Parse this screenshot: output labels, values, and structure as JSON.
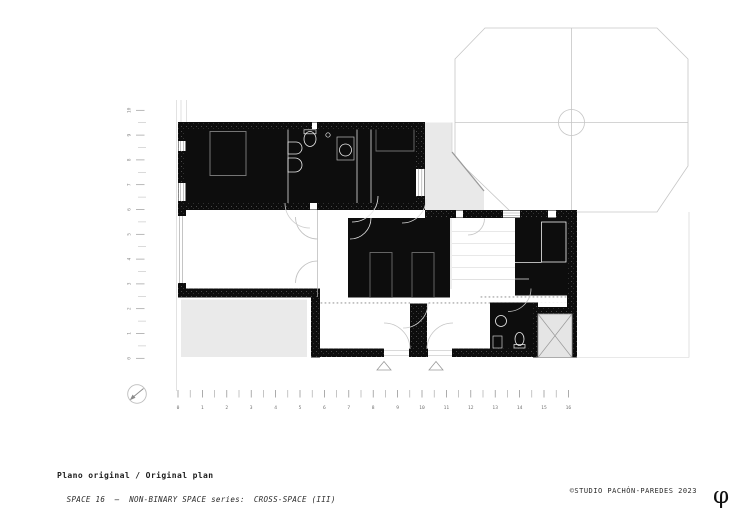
{
  "title_block": {
    "title": "Plano original / Original plan",
    "series_label": "SPACE 16  —  NON-BINARY SPACE series:",
    "series_value": "CROSS-SPACE (III)"
  },
  "footer": {
    "copyright": "©STUDIO PACHÓN-PAREDES 2023",
    "logo_glyph": "φ"
  },
  "scalebar": {
    "numbers": [
      "0",
      "1",
      "2",
      "3",
      "4",
      "5",
      "6",
      "7",
      "8",
      "9",
      "10",
      "11",
      "12",
      "13",
      "14",
      "15",
      "16"
    ]
  },
  "vertical_ruler": {
    "numbers": [
      "10",
      "9",
      "8",
      "7",
      "6",
      "5",
      "4",
      "3",
      "2",
      "1",
      "0"
    ]
  },
  "colors": {
    "ink": "#0d0d0d",
    "light_line": "#c6c6c6",
    "mid_gray": "#9a9a9a",
    "gray_fill": "#e9e9e9"
  }
}
